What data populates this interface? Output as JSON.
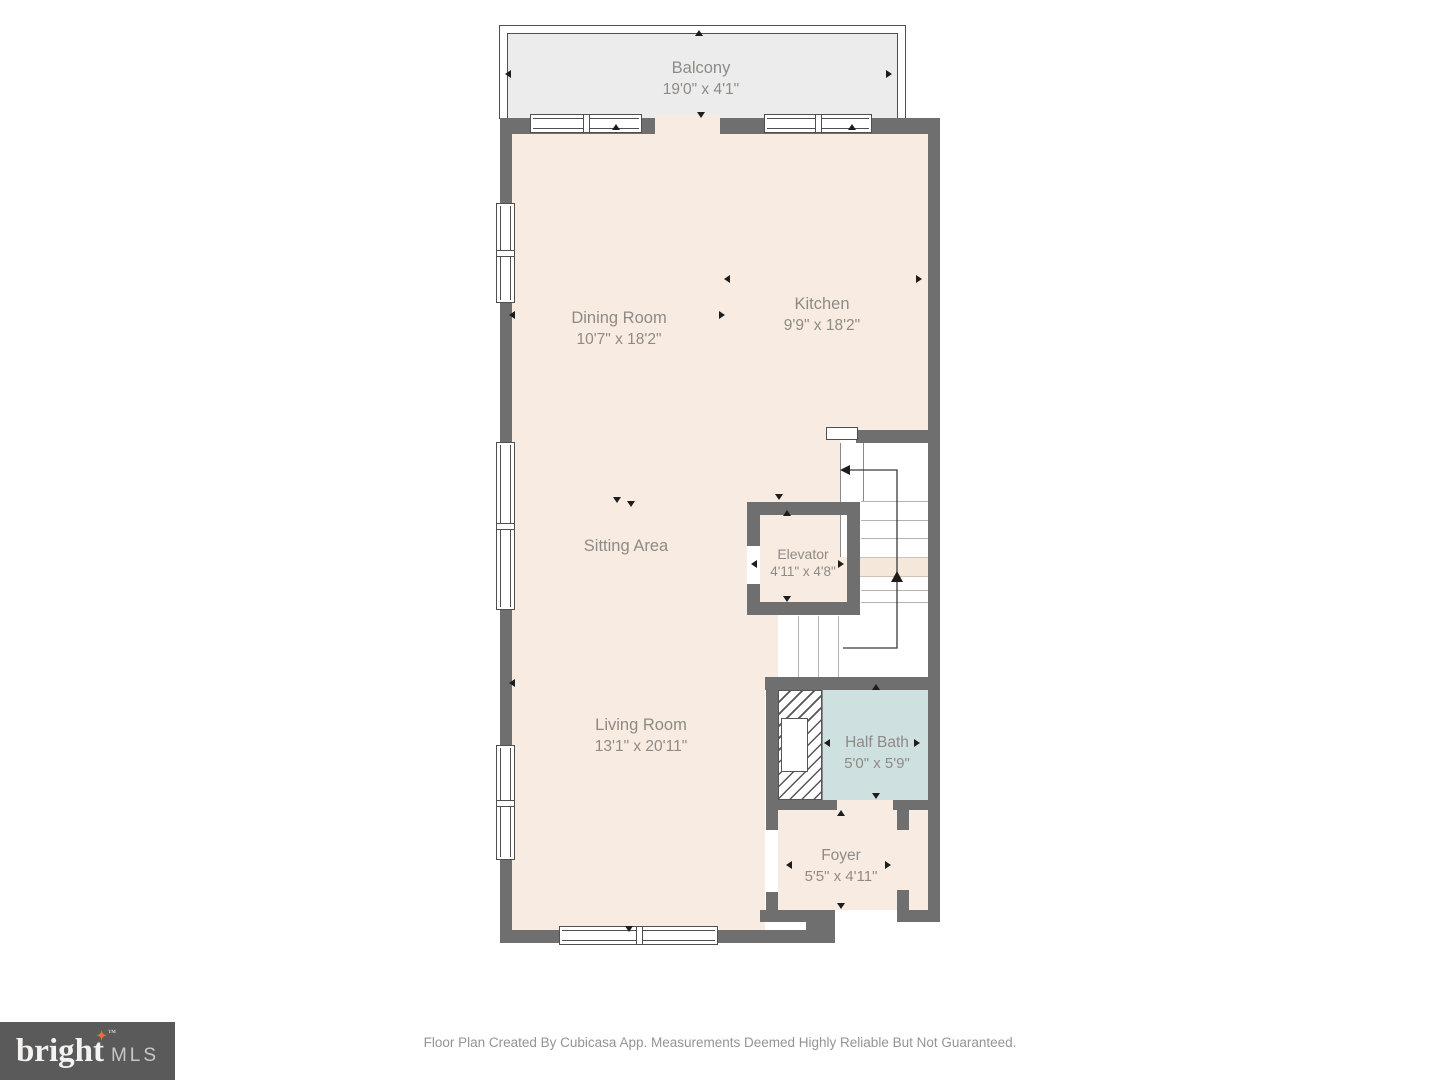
{
  "rooms": {
    "balcony": {
      "name": "Balcony",
      "dims": "19'0\" x 4'1\""
    },
    "dining_room": {
      "name": "Dining Room",
      "dims": "10'7\" x 18'2\""
    },
    "kitchen": {
      "name": "Kitchen",
      "dims": "9'9\" x 18'2\""
    },
    "sitting_area": {
      "name": "Sitting Area",
      "dims": ""
    },
    "elevator": {
      "name": "Elevator",
      "dims": "4'11\" x 4'8\""
    },
    "living_room": {
      "name": "Living Room",
      "dims": "13'1\" x 20'11\""
    },
    "half_bath": {
      "name": "Half Bath",
      "dims": "5'0\" x 5'9\""
    },
    "foyer": {
      "name": "Foyer",
      "dims": "5'5\" x 4'11\""
    }
  },
  "branding": {
    "logo_primary": "bright",
    "logo_star": "✦",
    "logo_tm": "™",
    "logo_secondary": "MLS"
  },
  "footer": {
    "disclaimer": "Floor Plan Created By Cubicasa App. Measurements Deemed Highly Reliable But Not Guaranteed."
  },
  "colors": {
    "wall": "#6f6f6f",
    "floor": "#f8ece2",
    "balcony_fill": "#ececec",
    "half_bath_fill": "#cfe0e0",
    "label_text": "#8e8a86",
    "logo_background": "#5a5a5a",
    "logo_star_color": "#e4703a"
  },
  "icons": {
    "measure_arrow": "small solid black triangle marker",
    "stair_direction_arrow": "thin polyline with arrowheads showing stair travel",
    "window_symbol": "white framed band in wall",
    "hatch_void": "diagonal hatched area under stairs"
  }
}
